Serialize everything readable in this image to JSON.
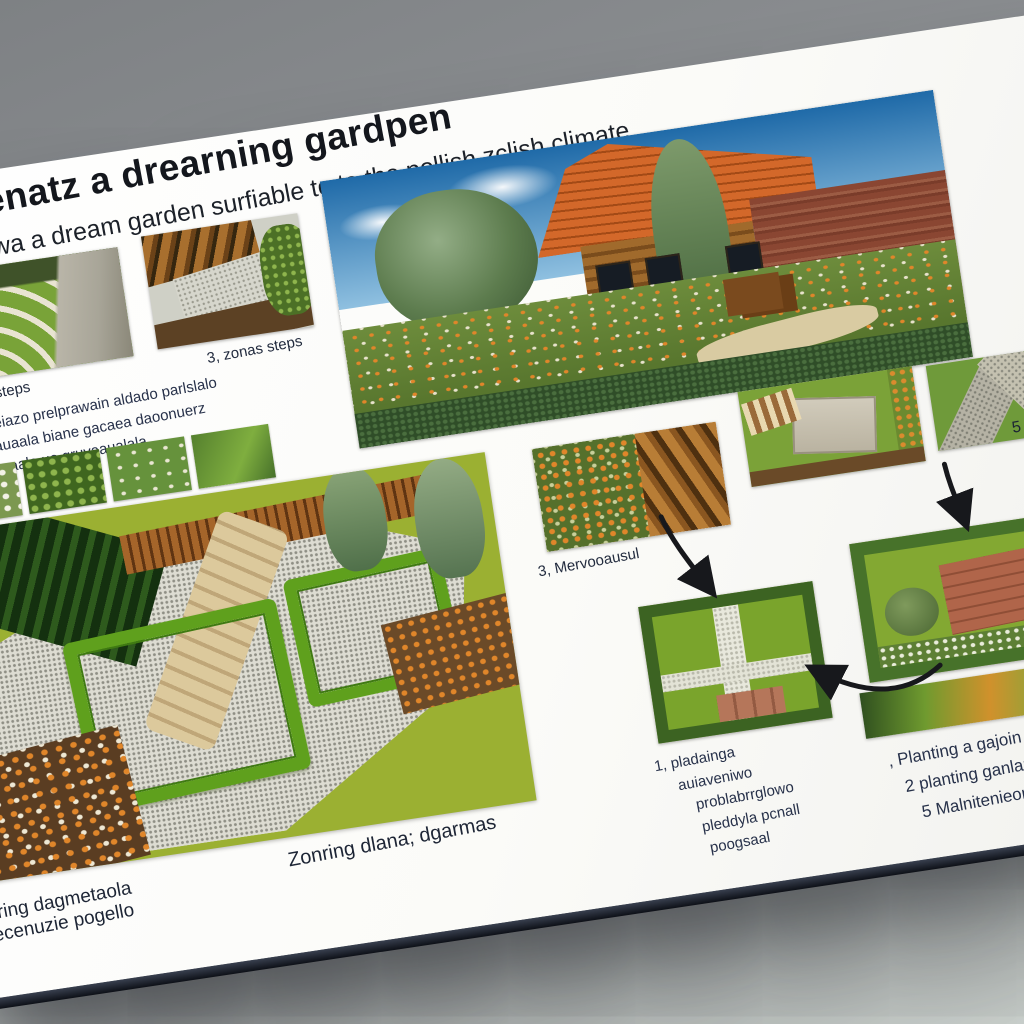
{
  "header": {
    "title": "srgenatz a drearning gardpen",
    "subtitle": "owa a dream garden surfiable to to the pollish zclish climate"
  },
  "gallery_top": {
    "photo1_caption": "sveldin, steps",
    "photo2_caption": "3, zonas steps"
  },
  "intro": {
    "line1": "ng oeiazo prelprawain aldado parlslalo",
    "line2": "eyauaala biane gacaea daoonuerz",
    "line3": "apnaaale uo gruvaaualala"
  },
  "flow": {
    "caption_meadow": "3, Mervooausul",
    "right_edge_label": "5"
  },
  "lists": {
    "center": [
      "1, pladainga",
      "auiaveniwo",
      "problabrrglowo",
      "pleddyla pcnall",
      "poogsaal"
    ],
    "right": [
      ", Planting a gajoin",
      "2 planting ganlang",
      "5 Malnitenieon"
    ]
  },
  "captions": {
    "zoning": "Zonring dlana; dgarmas",
    "bottom_left_line1": "nring dagmetaola",
    "bottom_left_line2": "grecenuzie pogello"
  },
  "photos": {
    "terraced_steps": "terraced-lawn-steps-photo",
    "zoned_bed": "zoned-garden-bed-photo",
    "hero": "cottage-house-garden-photo",
    "plants_strip": "plant-closeups-strip",
    "iso_plan": "isometric-garden-plan-render",
    "meadow_deck": "meadow-flowers-deck-photo",
    "patio_aerial": "stone-patio-aerial-photo",
    "paths_corner": "paved-paths-garden-photo",
    "brick_patio": "hedged-brick-patio-aerial-photo",
    "grid_garden": "gravel-grid-garden-aerial-photo",
    "foliage_strip": "blurred-foliage-strip"
  },
  "colors": {
    "background_gray": "#8b8e91",
    "card_white": "#fafaf8",
    "text_navy": "#232c3f",
    "title_black": "#14171d",
    "roof_orange": "#c05a1d",
    "lawn_green": "#9bb032",
    "hedge_green": "#5fa01d"
  }
}
